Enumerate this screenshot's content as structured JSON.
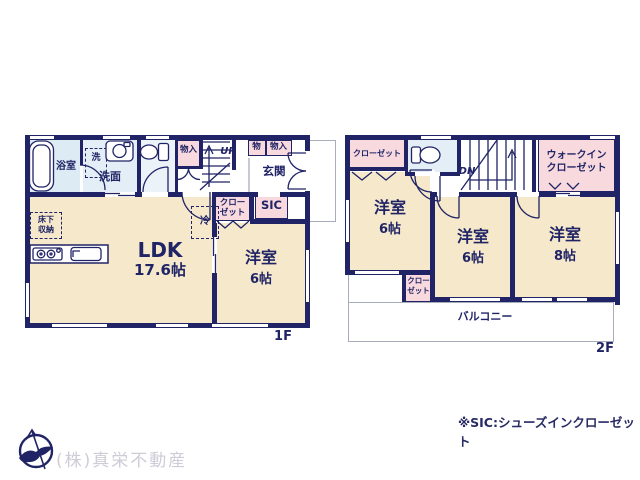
{
  "colors": {
    "wall": "#202466",
    "room_cream": "#f6e9cb",
    "closet_pink": "#f8d9de",
    "bath_blue": "#dcebf4",
    "balcony_outline": "#a9adbb",
    "company_text": "#cdccd7"
  },
  "floor1": {
    "floor_label": "1F",
    "bath": "浴室",
    "washer": "洗",
    "washroom": "洗面",
    "hall_storage": "物入",
    "stairs_up": "UP",
    "cabinet_small": "物",
    "cabinet": "物入",
    "entrance": "玄関",
    "closet_line1": "クロー",
    "closet_line2": "ゼット",
    "sic": "SIC",
    "fridge": "冷",
    "underfloor_line1": "床下",
    "underfloor_line2": "収納",
    "ldk": "LDK",
    "ldk_size": "17.6帖",
    "bedroom": "洋室",
    "bedroom_size": "6帖"
  },
  "floor2": {
    "floor_label": "2F",
    "closet": "クローゼット",
    "stairs_down": "DN",
    "wic_line1": "ウォークイン",
    "wic_line2": "クローゼット",
    "bedroom1": "洋室",
    "bedroom1_size": "6帖",
    "bedroom2": "洋室",
    "bedroom2_size": "6帖",
    "bedroom3": "洋室",
    "bedroom3_size": "8帖",
    "closet2_line1": "クロー",
    "closet2_line2": "ゼット",
    "balcony": "バルコニー"
  },
  "footer": {
    "company": "(株)真栄不動産",
    "sic_note": "※SIC:シューズインクローゼット"
  },
  "icons": {
    "fixtures": [
      "bathtub-icon",
      "washbasin-icon",
      "toilet-icon",
      "kitchen-stove-icon",
      "kitchen-sink-icon",
      "stairs-up-icon",
      "stairs-down-icon",
      "door-arc-icon",
      "company-logo-icon"
    ]
  }
}
